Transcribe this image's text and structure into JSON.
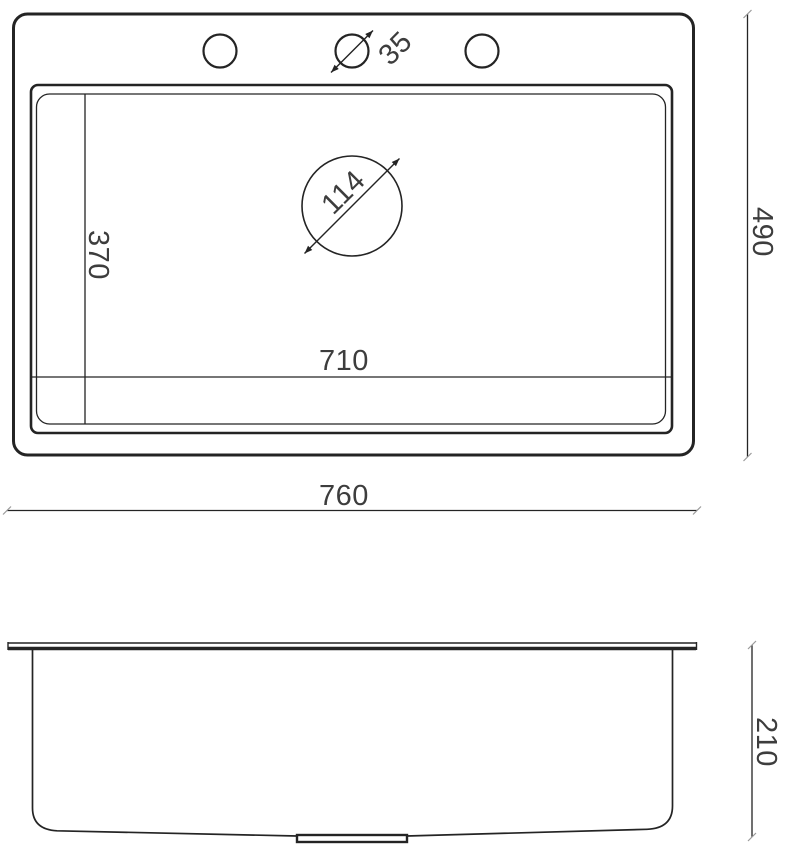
{
  "drawing": {
    "top_view": {
      "overall_width": "760",
      "overall_depth": "490",
      "bowl_width": "710",
      "bowl_depth": "370",
      "faucet_hole_diameter": "35",
      "drain_diameter": "114"
    },
    "side_view": {
      "height": "210"
    },
    "colors": {
      "line": "#242424",
      "text": "#3d3d3d",
      "background": "#ffffff"
    }
  }
}
